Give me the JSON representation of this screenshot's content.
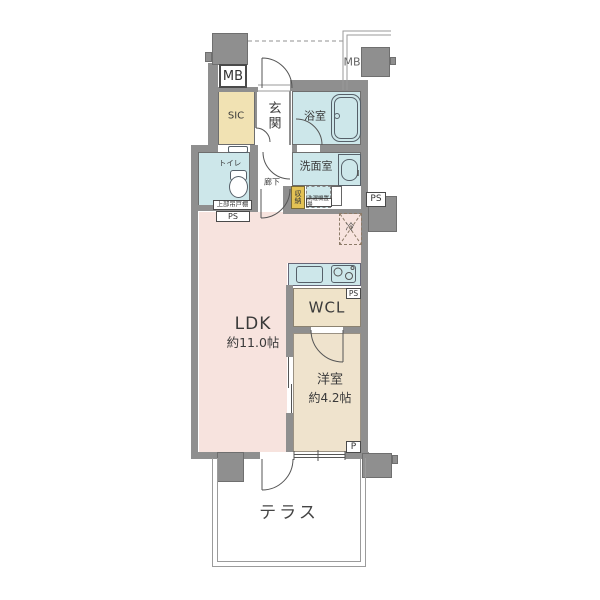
{
  "floorplan": {
    "labels": {
      "mb_left": "MB",
      "mb_right": "MB",
      "sic": "SIC",
      "entrance": "玄関",
      "bathroom": "浴室",
      "toilet": "トイレ",
      "upper_cabinet": "上部吊戸棚",
      "ps": "PS",
      "washroom": "洗面室",
      "hallway": "廊下",
      "storage": "収納",
      "washer": "洗濯機置場",
      "fridge": "冷",
      "ldk_name": "LDK",
      "ldk_size": "約11.0帖",
      "wcl": "WCL",
      "bedroom_name": "洋室",
      "bedroom_size": "約4.2帖",
      "p": "P",
      "terrace": "テラス"
    },
    "colors": {
      "ldk_pink": "#F7E3DE",
      "bedroom_tan": "#EFE3CD",
      "wcl_tan": "#EFE3C9",
      "sic_tan": "#F1E2B3",
      "storage_gold": "#E3C254",
      "water_blue": "#CDE7EA",
      "wall_gray": "#8F8F8F",
      "terrace_line": "#9B9B9B"
    }
  }
}
